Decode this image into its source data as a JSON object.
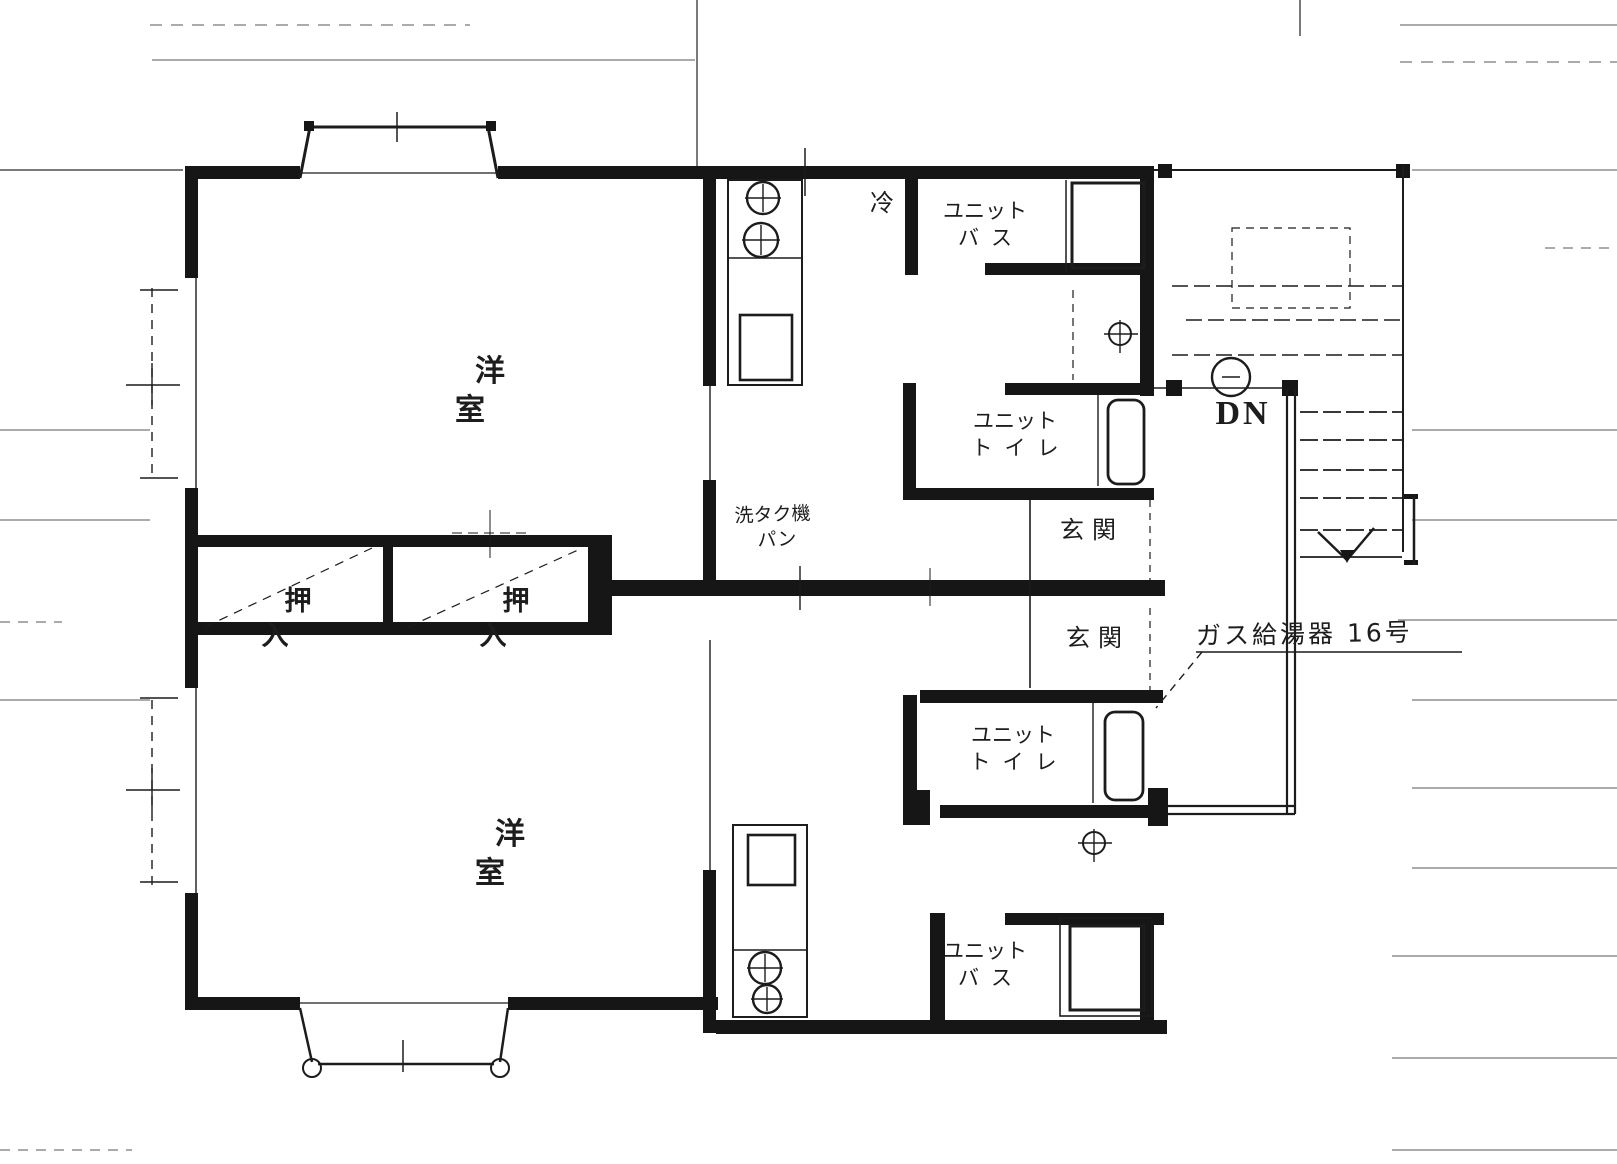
{
  "colors": {
    "ink": "#1c1c1c",
    "paper": "#ffffff",
    "faint_line": "#8f8f8f"
  },
  "plan": {
    "upper_unit": {
      "western_room": "洋室",
      "refrigerator": "冷",
      "unit_bath": {
        "line1": "ユニット",
        "line2": "バス"
      },
      "unit_toilet": {
        "line1": "ユニット",
        "line2": "トイレ"
      },
      "entrance": "玄関"
    },
    "lower_unit": {
      "western_room": "洋室",
      "unit_bath": {
        "line1": "ユニット",
        "line2": "バス"
      },
      "unit_toilet": {
        "line1": "ユニット",
        "line2": "トイレ"
      },
      "entrance": "玄関"
    },
    "closets": {
      "left": "押入",
      "right": "押入"
    },
    "laundry": {
      "line1": "洗タク機",
      "line2": "パン"
    },
    "stairs": {
      "down_label": "DN"
    },
    "water_heater_note": "ガス給湯器 16号"
  }
}
